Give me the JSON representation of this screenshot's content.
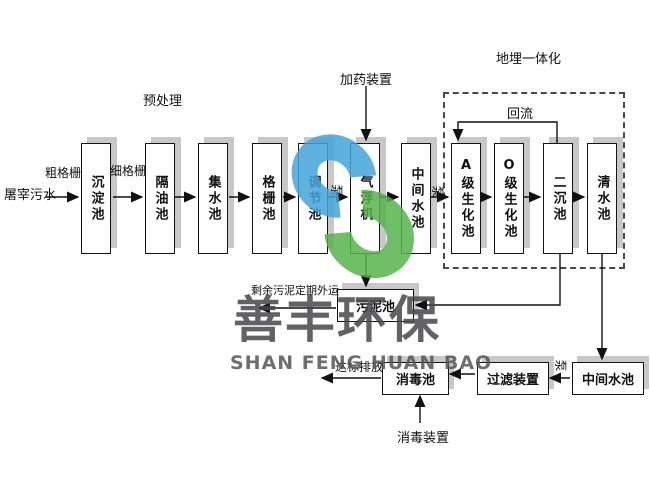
{
  "diagram": {
    "source": "屠宰污水",
    "sections": {
      "pretreatment": "预处理",
      "dosing_device": "加药装置",
      "buried_integration": "地埋一体化",
      "reflux": "回流"
    },
    "line_labels": {
      "coarse_screen": "粗格栅",
      "fine_screen": "细格栅",
      "pump": "泵",
      "excess_sludge": "剩余污泥定期外运",
      "standard_discharge": "达标排放",
      "disinfection_device": "消毒装置"
    },
    "main_tanks": [
      {
        "id": "sedimentation",
        "label": "沉淀池"
      },
      {
        "id": "oil-separation",
        "label": "隔油池"
      },
      {
        "id": "collection",
        "label": "集水池"
      },
      {
        "id": "screen",
        "label": "格栅池"
      },
      {
        "id": "regulating",
        "label": "调节池"
      },
      {
        "id": "air-flotation",
        "label": "气浮机"
      },
      {
        "id": "intermediate-1",
        "label": "中间水池"
      },
      {
        "id": "a-bio",
        "label": "A级生化池"
      },
      {
        "id": "o-bio",
        "label": "O级生化池"
      },
      {
        "id": "secondary-sedimentation",
        "label": "二沉池"
      },
      {
        "id": "clear-water",
        "label": "清水池"
      }
    ],
    "sludge_tank": "污泥池",
    "bottom_tanks": [
      {
        "id": "disinfection",
        "label": "消毒池"
      },
      {
        "id": "filter",
        "label": "过滤装置"
      },
      {
        "id": "intermediate-2",
        "label": "中间水池"
      }
    ]
  },
  "watermark": {
    "cn": "善丰环保",
    "en": "SHAN FENG HUAN BAO",
    "logo_blue": "#44a5db",
    "logo_green": "#57b44c"
  }
}
